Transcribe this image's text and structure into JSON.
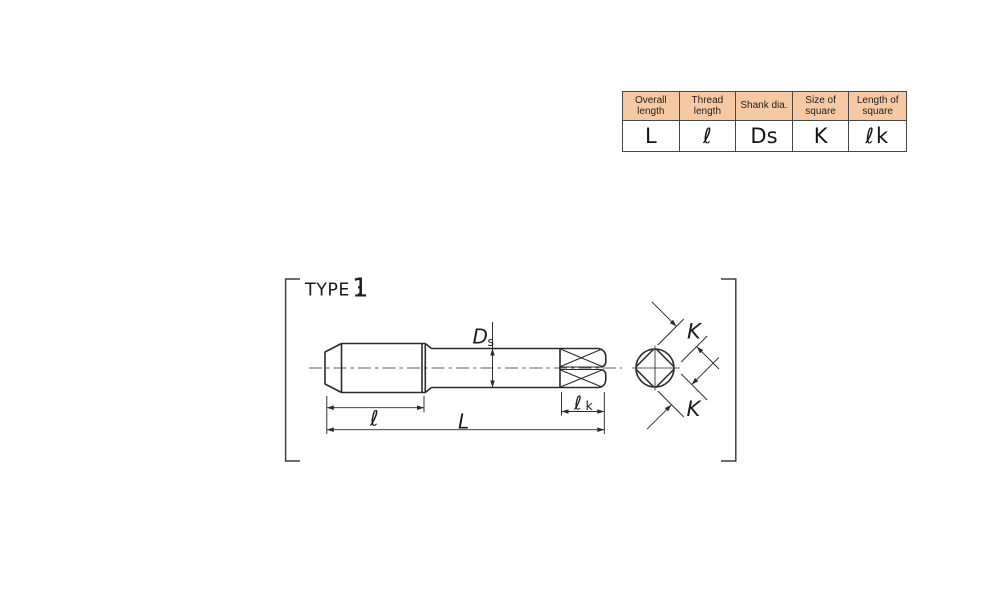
{
  "table": {
    "columns": [
      {
        "header": "Overall length",
        "symbol": "L"
      },
      {
        "header": "Thread length",
        "symbol": "ℓ"
      },
      {
        "header": "Shank dia.",
        "symbol": "Ds"
      },
      {
        "header": "Size of square",
        "symbol": "K"
      },
      {
        "header": "Length of square",
        "symbol": "ℓk"
      }
    ]
  },
  "drawing": {
    "type_prefix": "TYPE :",
    "type_number": "1",
    "labels": {
      "thread_length": "ℓ",
      "overall_length": "L",
      "shank_dia_main": "D",
      "shank_dia_sub": "s",
      "square_len_main": "ℓ",
      "square_len_sub": "k",
      "square_size_top": "K",
      "square_size_bottom": "K"
    }
  },
  "colors": {
    "header_bg": "#f6c9a3",
    "table_border": "#474747",
    "line": "#2a2a2a"
  }
}
